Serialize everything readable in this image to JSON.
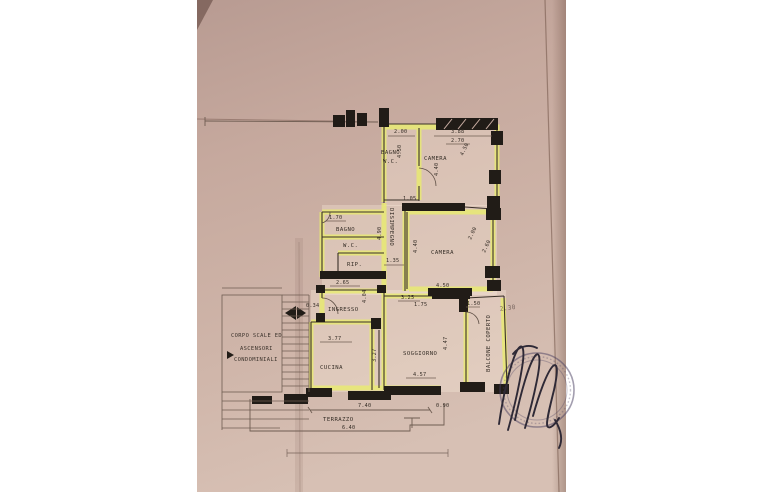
{
  "photo": {
    "type": "photograph of a paper floor plan (planimetria catastale)",
    "paper_color": "#c7aba0",
    "highlight_color": "#e9ec6f",
    "ink_color": "#211c17",
    "background_color": "#ffffff"
  },
  "floor_plan": {
    "rooms": {
      "bagno_top": {
        "label": "BAGNO",
        "wc": "W.C."
      },
      "camera_top": {
        "label": "CAMERA"
      },
      "bagno_mid": {
        "label": "BAGNO",
        "wc": "W.C.",
        "rip": "RIP."
      },
      "disimpegno": {
        "label": "DISIMPEGNO"
      },
      "camera_mid": {
        "label": "CAMERA"
      },
      "ingresso": {
        "label": "INGRESSO"
      },
      "cucina": {
        "label": "CUCINA"
      },
      "soggiorno": {
        "label": "SOGGIORNO"
      },
      "balcone": {
        "label": "BALCONE COPERTO"
      },
      "terrazzo": {
        "label": "TERRAZZO"
      },
      "stairwell": {
        "line1": "CORPO SCALE ED",
        "line2": "ASCENSORI",
        "line3": "CONDOMINIALI"
      }
    },
    "dimensions": {
      "bagno_top_width": "2.00",
      "bagno_top_depth": "4.50",
      "camera_top_width": "3.88",
      "camera_top_width_inner": "2.70",
      "camera_top_depth": "4.40",
      "camera_top_side": "4.50",
      "bagno_mid_width": "1.70",
      "bagno_mid_bottom": "2.65",
      "disimpegno_length": "4.90",
      "disimpegno_width": "1.35",
      "camera_mid_top": "1.05",
      "camera_mid_depth": "4.40",
      "camera_mid_width": "4.50",
      "camera_mid_side_a": "2.00",
      "camera_mid_side_b": "2.60",
      "ingresso_door": "0.34",
      "ingresso_length": "4.04",
      "cucina_width": "3.77",
      "cucina_side": "3.27",
      "soggiorno_top_a": "3.25",
      "soggiorno_top_b": "1.75",
      "soggiorno_width": "4.57",
      "soggiorno_side": "4.47",
      "balcone_top": "1.50",
      "balcone_note": "2.30",
      "terrazzo_width": "7.40",
      "terrazzo_inner": "6.40",
      "terrazzo_step": "0.90"
    }
  }
}
